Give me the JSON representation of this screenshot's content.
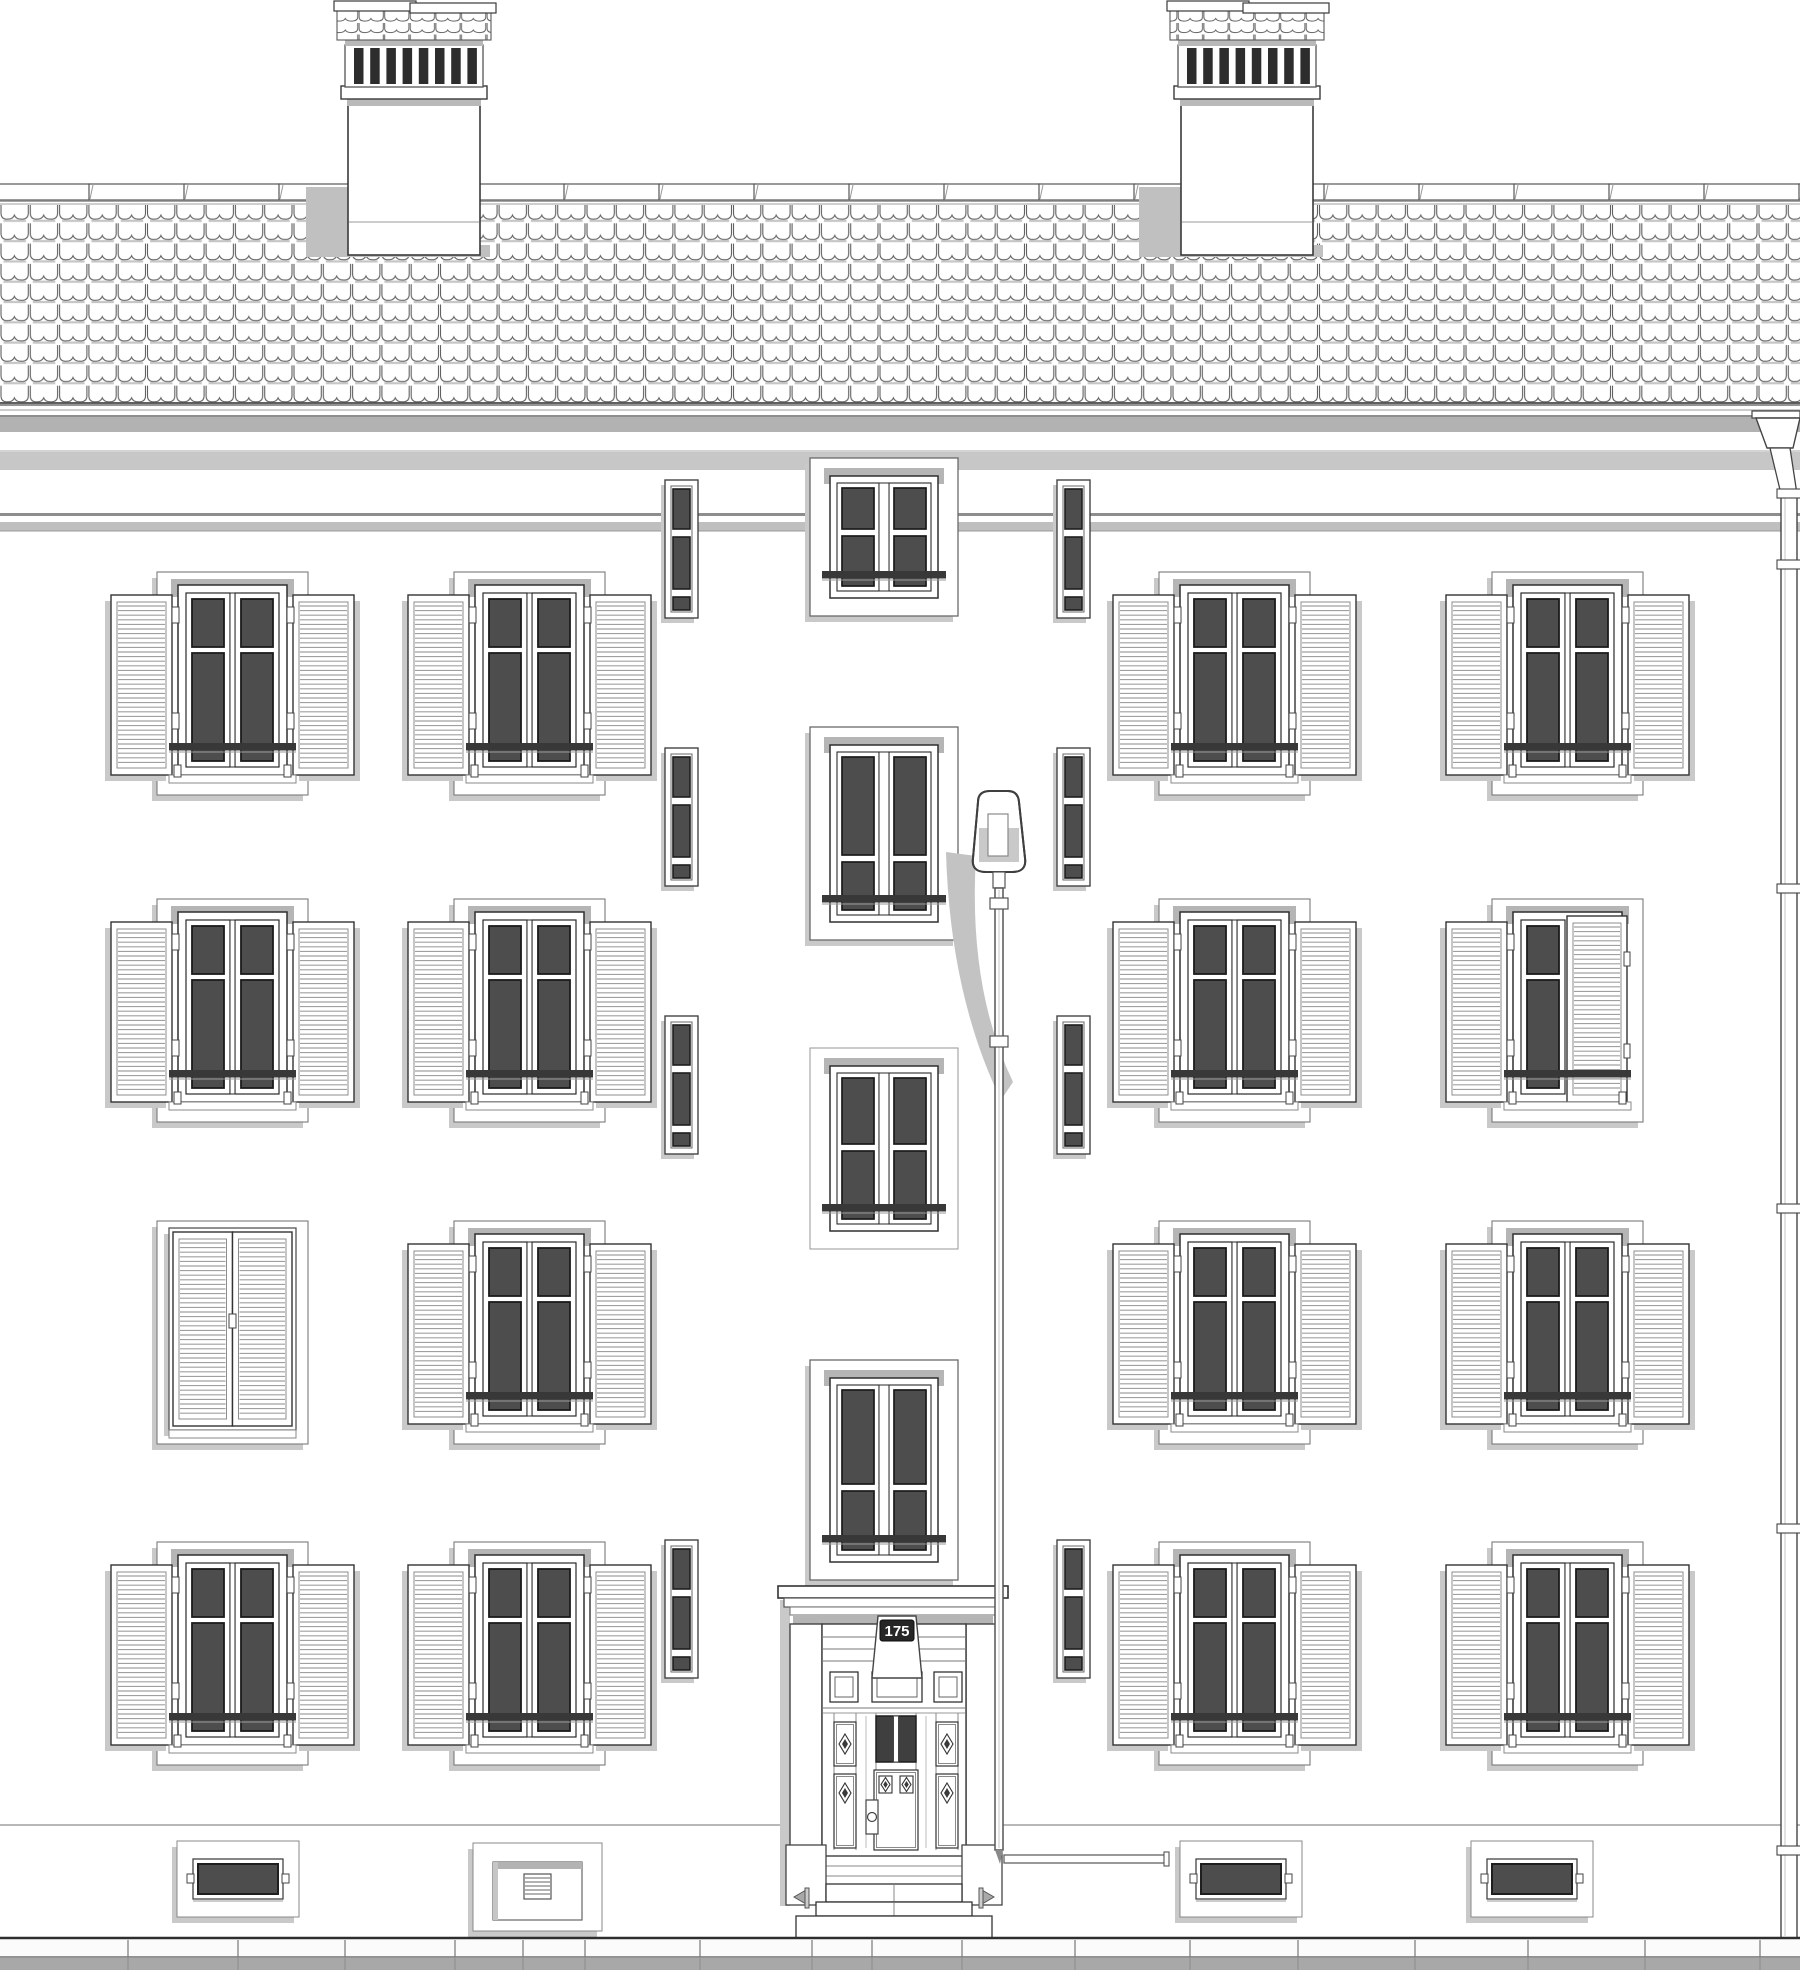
{
  "door": {
    "number_plate": "175"
  },
  "palette": {
    "line": "#3a3a3a",
    "line_soft": "#6e6e6e",
    "glass": "#4d4d4d",
    "shadow": "#c0c0c0",
    "shadow_light": "#c9c9c9",
    "band_gray": "#b5b5b5",
    "louver": "#a0a0a0",
    "slat_dark": "#2d2d2d",
    "curb_gray": "#a8a8a8"
  },
  "facade": {
    "window_grid": {
      "unit_w": 243,
      "unit_h": 232,
      "cols_x": [
        111,
        408,
        1113,
        1446
      ],
      "rows_y": [
        569,
        896,
        1218,
        1539
      ],
      "variants": [
        [
          "open",
          "open",
          "open",
          "open"
        ],
        [
          "open",
          "open",
          "open",
          "shutter-half-closed"
        ],
        [
          "shutters-closed",
          "open",
          "open",
          "open"
        ],
        [
          "open",
          "open",
          "open",
          "open"
        ]
      ]
    },
    "stair_slit_windows": {
      "cols_x": [
        665,
        1057
      ],
      "rows_y": [
        480,
        748,
        1016,
        1540
      ],
      "w": 33,
      "h": 138
    },
    "center_windows": [
      {
        "y": 458,
        "h": 158,
        "style": "raised",
        "top_pane_frac": 0.38
      },
      {
        "y": 727,
        "h": 213,
        "style": "raised",
        "top_pane_frac": 0.6
      },
      {
        "y": 1048,
        "h": 201,
        "style": "outline",
        "top_pane_frac": 0.44
      },
      {
        "y": 1360,
        "h": 220,
        "style": "raised",
        "top_pane_frac": 0.55
      }
    ],
    "chimneys_x": [
      348,
      1181
    ],
    "basement_items": [
      {
        "type": "window",
        "x": 177
      },
      {
        "type": "vent",
        "x": 473
      },
      {
        "type": "window",
        "x": 1180
      },
      {
        "type": "window",
        "x": 1471
      }
    ],
    "pavement_joints_x": [
      128,
      238,
      345,
      455,
      523,
      585,
      700,
      812,
      872,
      962,
      1075,
      1190,
      1298,
      1415,
      1528,
      1645,
      1760
    ],
    "lamp": {
      "x": 999,
      "head_top_y": 790,
      "wire_bar_y": 1855,
      "wire_bar_x2": 1166
    },
    "downspout": {
      "pipe_x": 1781,
      "collar_ys": [
        489,
        560,
        884,
        1204,
        1524,
        1846
      ]
    }
  }
}
